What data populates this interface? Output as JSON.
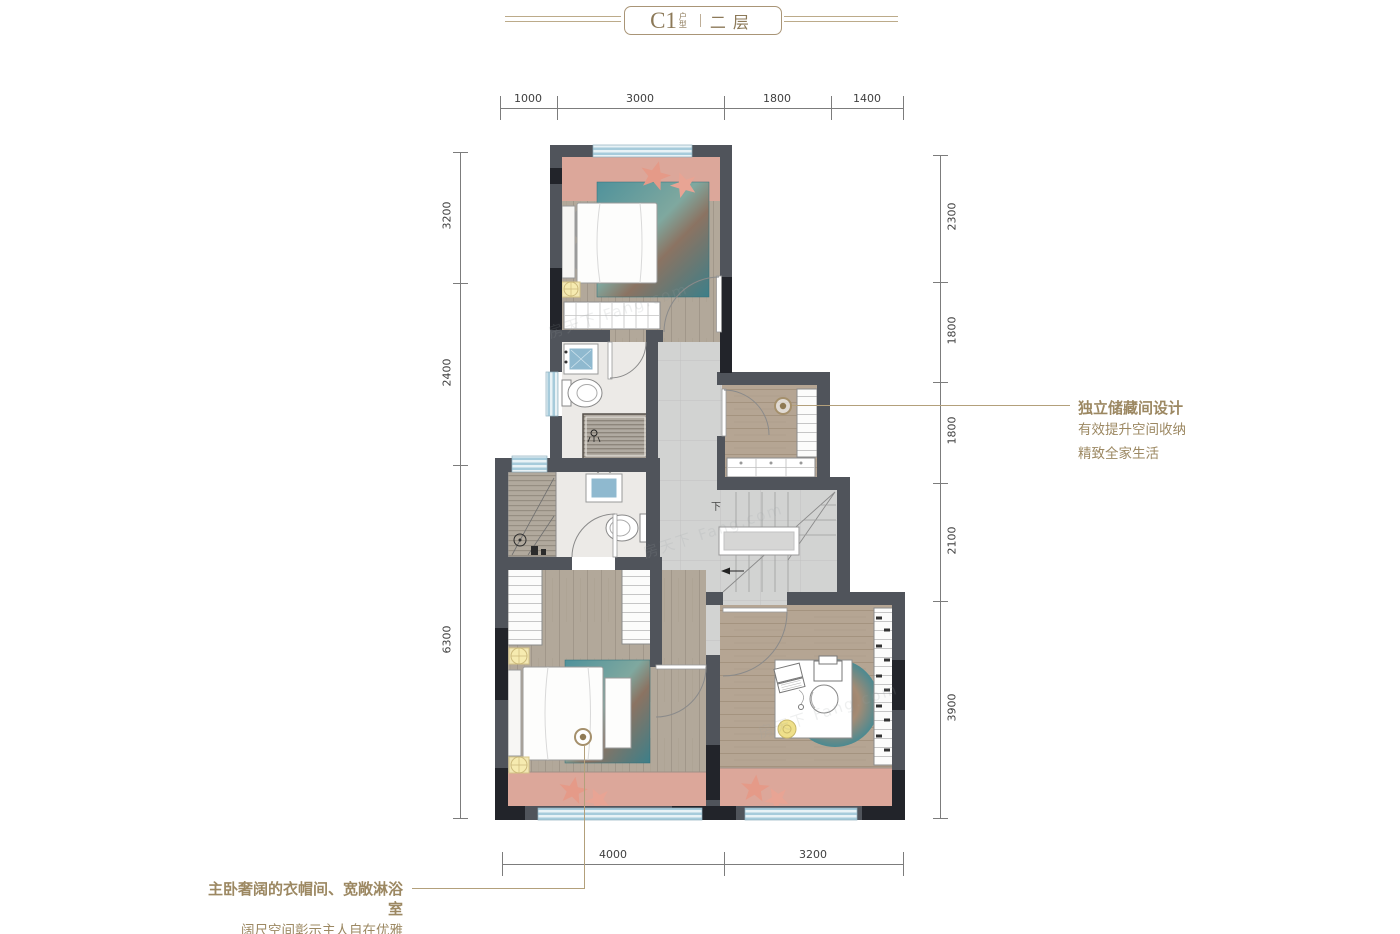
{
  "title": {
    "code": "C1",
    "code_suffix": "户型",
    "divider": "|",
    "floor": "二层"
  },
  "dimensions": {
    "top": [
      "1000",
      "3000",
      "1800",
      "1400"
    ],
    "bottom": [
      "4000",
      "3200"
    ],
    "left": [
      "3200",
      "2400",
      "6300"
    ],
    "right": [
      "2300",
      "1800",
      "1800",
      "2100",
      "3900"
    ]
  },
  "annotations": {
    "storage": {
      "line1": "独立储藏间设计",
      "line2": "有效提升空间收纳",
      "line3": "精致全家生活"
    },
    "master": {
      "line1": "主卧奢阔的衣帽间、宽敞淋浴室",
      "line2": "阔尺空间彰示主人自在优雅"
    }
  },
  "plan": {
    "stair_label": "下"
  },
  "watermark": {
    "text": "房天下 Fang.com"
  },
  "colors": {
    "accent_gold": "#a5906c",
    "wall_dark": "#50545b",
    "wall_black": "#22242a",
    "balcony_pink": "#dca79a",
    "window_blue": "#a6cbdb",
    "wood_floor": "#b2a89a",
    "tile_gray": "#d2d3d2",
    "rug_teal": "#4a8f98"
  }
}
